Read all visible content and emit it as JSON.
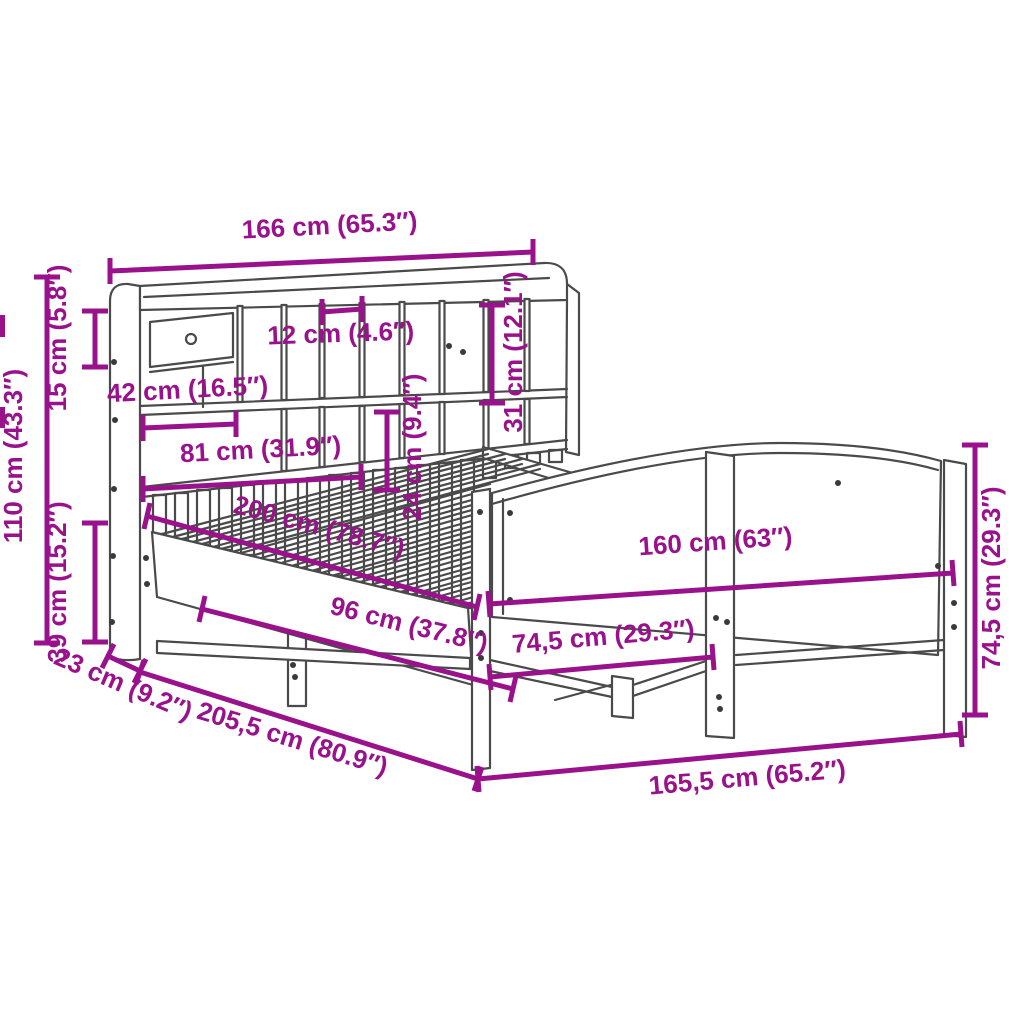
{
  "diagram": {
    "type": "furniture-dimension-diagram",
    "subject": "bookcase bed frame with storage headboard and arched footboard",
    "background": "#ffffff",
    "accent_color": "#9A118C",
    "line_color": "#4a4a4a",
    "dims": {
      "overall_width": {
        "label": "166 cm (65.3″)"
      },
      "shelf_top": {
        "label": "15 cm (5.8″)"
      },
      "headboard_height": {
        "label": "110 cm (43.3″)"
      },
      "frame_height": {
        "label": "39 cm (15.2″)"
      },
      "headboard_depth": {
        "label": "23 cm (9.2″)"
      },
      "overall_length": {
        "label": "205,5 cm (80.9″)"
      },
      "footboard_outer_width": {
        "label": "165,5 cm (65.2″)"
      },
      "footboard_height": {
        "label": "74,5 cm (29.3″)"
      },
      "bed_width": {
        "label": "160 cm (63″)"
      },
      "leg_spacing": {
        "label": "74,5 cm (29.3″)"
      },
      "support_spacing": {
        "label": "96 cm (37.8″)"
      },
      "bed_length": {
        "label": "200 cm (78.7″)"
      },
      "slat_section_width": {
        "label": "81 cm (31.9″)"
      },
      "drawer_width": {
        "label": "42 cm (16.5″)"
      },
      "cubby_width": {
        "label": "12 cm (4.6″)"
      },
      "row2_height": {
        "label": "24 cm (9.4″)"
      },
      "row1_height": {
        "label": "31 cm (12.1″)"
      }
    }
  }
}
